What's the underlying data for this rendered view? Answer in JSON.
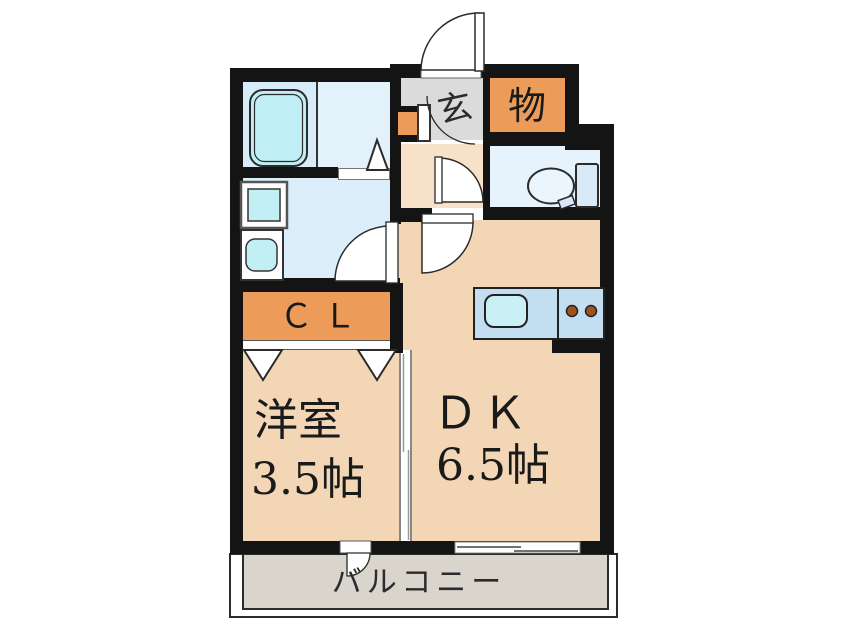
{
  "floorplan": {
    "type": "apartment-floor-plan",
    "rooms": {
      "dining_kitchen": {
        "label": "ＤＫ",
        "size": "6.5帖"
      },
      "western_room": {
        "label": "洋室",
        "size": "3.5帖"
      },
      "closet": {
        "label": "Ｃ Ｌ"
      },
      "storage": {
        "label": "物"
      },
      "entrance": {
        "label": "玄"
      },
      "balcony": {
        "label": "バルコニー"
      }
    },
    "fixtures": [
      "bathtub",
      "washing-machine",
      "vanity-sink",
      "toilet",
      "kitchen-sink",
      "stove-2-burners"
    ],
    "colors": {
      "wall": "#141414",
      "room_peach": "#F3D6B6",
      "hall_peach": "#F7E1C8",
      "closet_orange": "#EC9C58",
      "bath_blue": "#D8EBF8",
      "washroom_blue": "#DCEEFA",
      "toilet_blue": "#E6F2FC",
      "fixture_cyan": "#C2EFF4",
      "counter_blue": "#C3DDF1",
      "entrance_gray": "#DBDBDB",
      "balcony_gray": "#D9D4CC",
      "burner_brown": "#A0521C"
    }
  }
}
